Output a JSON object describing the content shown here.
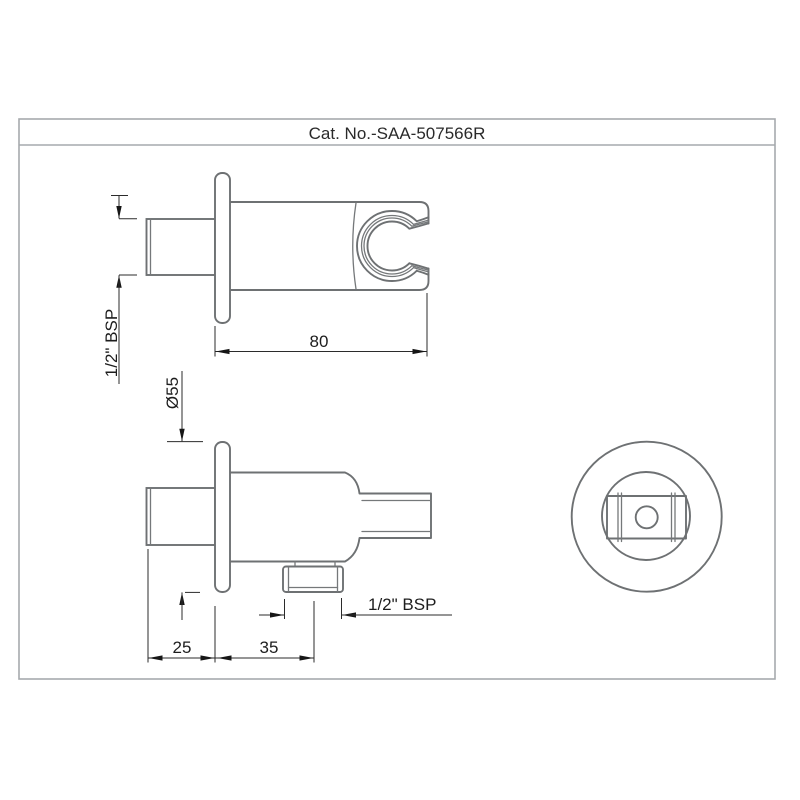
{
  "title_block": {
    "catalog_number": "Cat. No.-SAA-507566R"
  },
  "dimensions": {
    "inlet_thread": "1/2\" BSP",
    "body_length": "80",
    "flange_diameter": "Ø55",
    "wall_to_stub_end": "25",
    "flange_to_outlet": "35",
    "outlet_thread": "1/2\" BSP"
  },
  "colors": {
    "part_line": "#6e7173",
    "dimension_line": "#2b2b2b",
    "frame_line": "#a6aaad",
    "text": "#1d1d1d",
    "background": "#ffffff"
  }
}
